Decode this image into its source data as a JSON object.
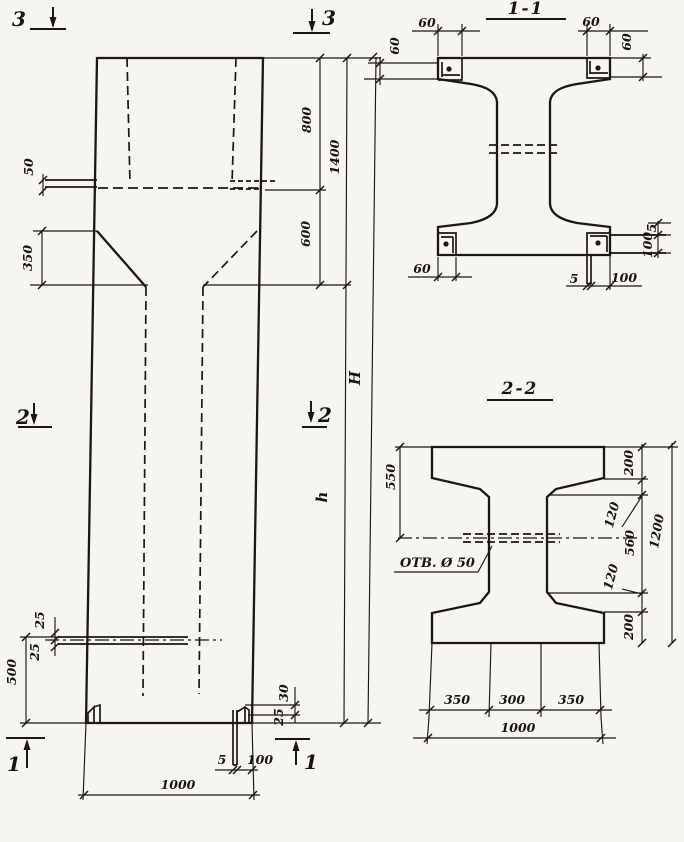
{
  "front_view": {
    "section_markers": {
      "top_left": "3",
      "top_right": "3",
      "mid_left": "2",
      "mid_right": "2",
      "bottom_left": "1",
      "bottom_right": "1"
    },
    "dimensions": {
      "plate_offset": "50",
      "taper_height": "350",
      "head_upper": "800",
      "head_total": "1400",
      "head_lower": "600",
      "total_height": "H",
      "shaft_height": "h",
      "hole_upper": "25",
      "hole_lower": "25",
      "hole_elevation": "500",
      "base_plate_a": "30",
      "base_plate_b": "25",
      "base_strip_thk": "5",
      "base_strip_len": "100",
      "width": "1000"
    }
  },
  "section_1_1": {
    "title": "1-1",
    "dimensions": {
      "plate_tl_w": "60",
      "plate_tl_h": "60",
      "plate_tr_w": "60",
      "plate_tr_h": "60",
      "plate_bl_w": "60",
      "strip_thk_bottom": "5",
      "strip_len_bottom": "100",
      "strip_thk_right": "5",
      "strip_len_right": "100"
    }
  },
  "section_2_2": {
    "title": "2-2",
    "hole_note": "ОТВ. Ø 50",
    "dimensions": {
      "flange_to_hole": "550",
      "flange_top": "200",
      "chamfer_top": "120",
      "web_clear": "560",
      "chamfer_bottom": "120",
      "flange_bottom": "200",
      "depth_total": "1200",
      "flange_left": "350",
      "web_width": "300",
      "flange_right": "350",
      "width_total": "1000"
    }
  }
}
